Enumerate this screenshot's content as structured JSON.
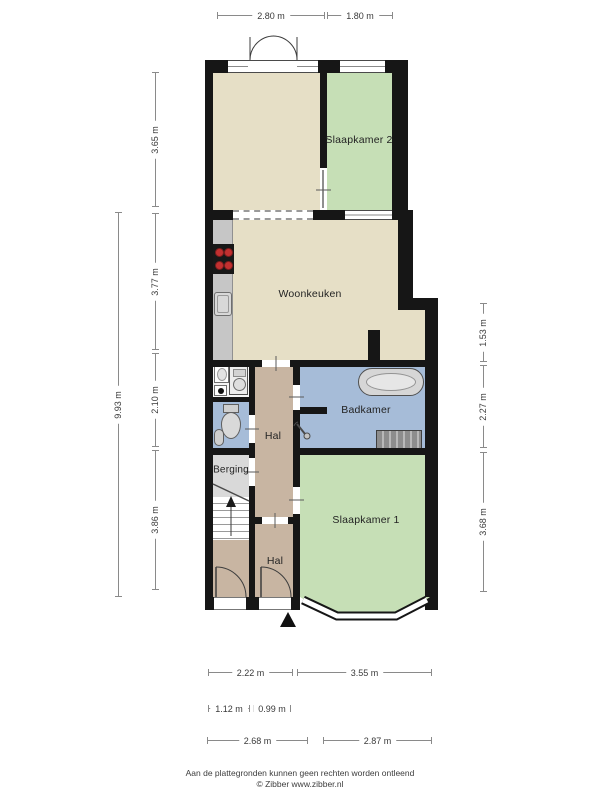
{
  "plan": {
    "rooms": {
      "slaapkamer2": "Slaapkamer 2",
      "woonkeuken": "Woonkeuken",
      "badkamer": "Badkamer",
      "hal_upper": "Hal",
      "berging": "Berging",
      "hal_lower": "Hal",
      "slaapkamer1": "Slaapkamer 1"
    }
  },
  "dimensions": {
    "top": [
      "2.80 m",
      "1.80 m"
    ],
    "left_total": "9.93 m",
    "left": [
      "3.65 m",
      "3.77 m",
      "2.10 m",
      "3.86 m"
    ],
    "right": [
      "1.53 m",
      "2.27 m",
      "3.68 m"
    ],
    "bottom_row1": [
      "2.22 m",
      "3.55 m"
    ],
    "bottom_row2": [
      "1.12 m",
      "0.99 m"
    ],
    "bottom_row3": [
      "2.68 m",
      "2.87 m"
    ]
  },
  "footer": {
    "disclaimer": "Aan de plattegronden kunnen geen rechten worden ontleend",
    "credit": "© Zibber www.zibber.nl"
  },
  "icons": {
    "north_arrow": "solid-up-triangle",
    "stairs_arrow": "up-arrow"
  },
  "colors": {
    "wall": "#161616",
    "beige": "#e6dfc6",
    "green": "#c6dfb6",
    "blue": "#a6bcd8",
    "brown": "#c8b5a2",
    "gray": "#d9d9d9",
    "counter": "#c6c6c6"
  }
}
